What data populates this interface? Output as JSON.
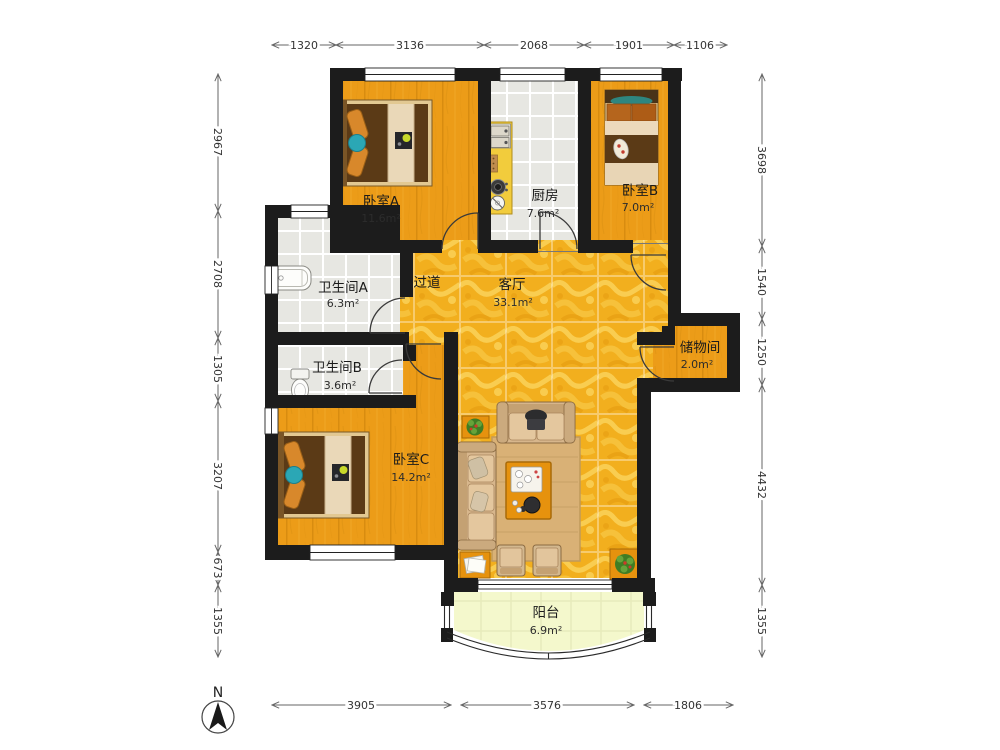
{
  "compass": {
    "north_label": "N"
  },
  "rooms": {
    "bedroom_a": {
      "name": "卧室A",
      "area": "11.6m²"
    },
    "kitchen": {
      "name": "厨房",
      "area": "7.6m²"
    },
    "bedroom_b": {
      "name": "卧室B",
      "area": "7.0m²"
    },
    "bathroom_a": {
      "name": "卫生间A",
      "area": "6.3m²"
    },
    "bathroom_b": {
      "name": "卫生间B",
      "area": "3.6m²"
    },
    "hallway": {
      "name": "过道"
    },
    "living_room": {
      "name": "客厅",
      "area": "33.1m²"
    },
    "storage": {
      "name": "储物间",
      "area": "2.0m²"
    },
    "bedroom_c": {
      "name": "卧室C",
      "area": "14.2m²"
    },
    "balcony": {
      "name": "阳台",
      "area": "6.9m²"
    }
  },
  "dims": {
    "top": [
      "1320",
      "3136",
      "2068",
      "1901",
      "1106"
    ],
    "left": [
      "2967",
      "2708",
      "1305",
      "3207",
      "673",
      "1355"
    ],
    "right": [
      "3698",
      "1540",
      "1250",
      "4432",
      "1355"
    ],
    "bottom": [
      "3905",
      "3576",
      "1806"
    ]
  },
  "colors": {
    "wall": "#1c1c1c",
    "bedroom_floor": "#EC9C18",
    "living_floor": "#F2AF1E",
    "tile_floor": "#E7E7E2",
    "balcony_floor": "#F4F8CC",
    "counter": "#F2CC3C"
  }
}
